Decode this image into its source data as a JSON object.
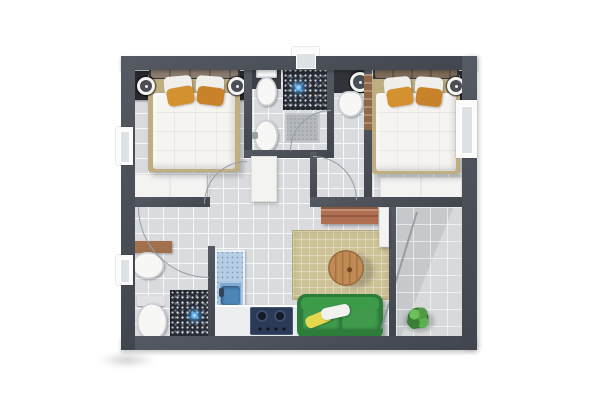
{
  "meta": {
    "title": "Two-bedroom apartment floor plan (top-down 3D render)",
    "view": "top-down",
    "canvas": {
      "width": 600,
      "height": 400
    }
  },
  "theme": {
    "page-bg": "#ffffff",
    "wall": "#555a63",
    "wall-dark": "#41454d",
    "floor": "#d9dbde",
    "balcony-floor": "#c6c9cc",
    "mosaic": "#272c35",
    "drain-blue": "#4aa3e8",
    "bed-frame": "#bfae82",
    "duvet": "#f5f4f1",
    "headboard": "#35383e",
    "pillow-taupe": "#8a7b6e",
    "pillow-orange": "#d3912f",
    "pillow-yellow": "#e6d94d",
    "nightstand": "#27292e",
    "white-furniture": "#f3f3f2",
    "rug": "#cdc196",
    "table-wood": "#c08a55",
    "sofa-green": "#3f9a4c",
    "sofa-green-dark": "#2b7d39",
    "kitchen-blue": "#b5cde5",
    "kitchen-sink-blue": "#4f86b8",
    "stove-navy": "#2b3a57",
    "counter-white": "#eceef0",
    "console-wood": "#b06f50",
    "vanity-wood": "#a1714d",
    "door-wood": "#8f6847",
    "plant-green": "#3f8c3c",
    "mat-gray": "#b4b8bd",
    "arc": "#979da6",
    "window-pane": "#dfe2e5"
  },
  "rooms": [
    {
      "id": "bedroom-1",
      "name": "bedroom (left)"
    },
    {
      "id": "bathroom-1",
      "name": "bathroom with shower (top middle)"
    },
    {
      "id": "bathroom-2",
      "name": "small bathroom (middle)"
    },
    {
      "id": "bedroom-2",
      "name": "bedroom (right)"
    },
    {
      "id": "bathroom-3",
      "name": "bathroom with shower (bottom left)"
    },
    {
      "id": "kitchen",
      "name": "kitchen (L-shaped counter)"
    },
    {
      "id": "living-room",
      "name": "living room"
    },
    {
      "id": "hallway",
      "name": "hallway"
    },
    {
      "id": "balcony",
      "name": "balcony (right)"
    }
  ],
  "furniture": [
    "double-bed-with-orange-pillows-x2",
    "nightstand-with-round-lamp-x3",
    "white-wardrobe-x3",
    "toilet-x3",
    "washbasin-x3",
    "round-vanity-basin",
    "mosaic-shower-floor-x2",
    "shower-drain-x2",
    "bath-mat",
    "kitchen-sink",
    "gas-stove-2-burners",
    "wooden-console",
    "beige-rug",
    "round-wooden-coffee-table",
    "green-sofa-with-yellow-and-white-pillows",
    "potted-plant",
    "wooden-interior-door",
    "door-swing-arc-x5",
    "window-x4",
    "top-wall-opening"
  ]
}
